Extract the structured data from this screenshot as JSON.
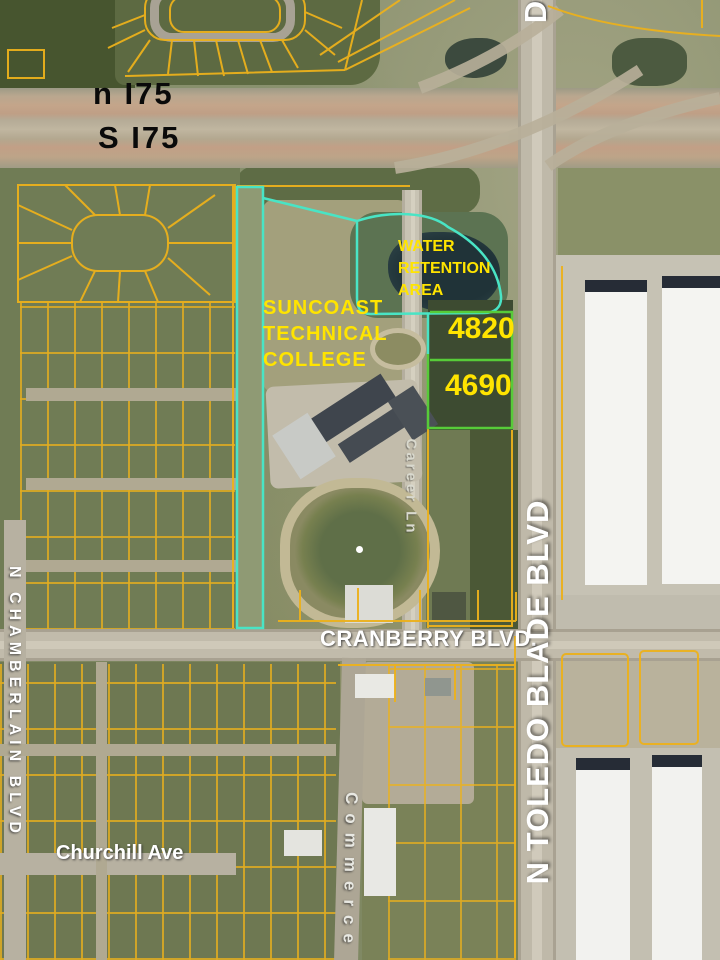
{
  "map_labels": {
    "i75_north": "n I75",
    "i75_south": "S I75",
    "water_retention_area": "WATER\n RETENTION\nAREA",
    "college": "SUNCOAST\nTECHNICAL\nCOLLEGE",
    "parcel_4820": "4820",
    "parcel_4690": "4690",
    "cranberry_blvd": "CRANBERRY BLVD.",
    "toledo_blade_blvd": "N TOLEDO BLADE BLVD",
    "toledo_blade_partial": "D",
    "chamberlain_blvd": "N CHAMBERLAIN BLVD",
    "churchill_ave": "Churchill Ave",
    "career_ln": "Career Ln",
    "commerce": "Commerce"
  },
  "colors": {
    "parcel_outline_yellow": "#ecb11c",
    "highlight_outline_cyan": "#49e4c5",
    "parcel_outline_green": "#57cb39",
    "label_yellow": "#ffe400",
    "label_black": "#0a0a0a",
    "label_white": "#ffffff"
  }
}
